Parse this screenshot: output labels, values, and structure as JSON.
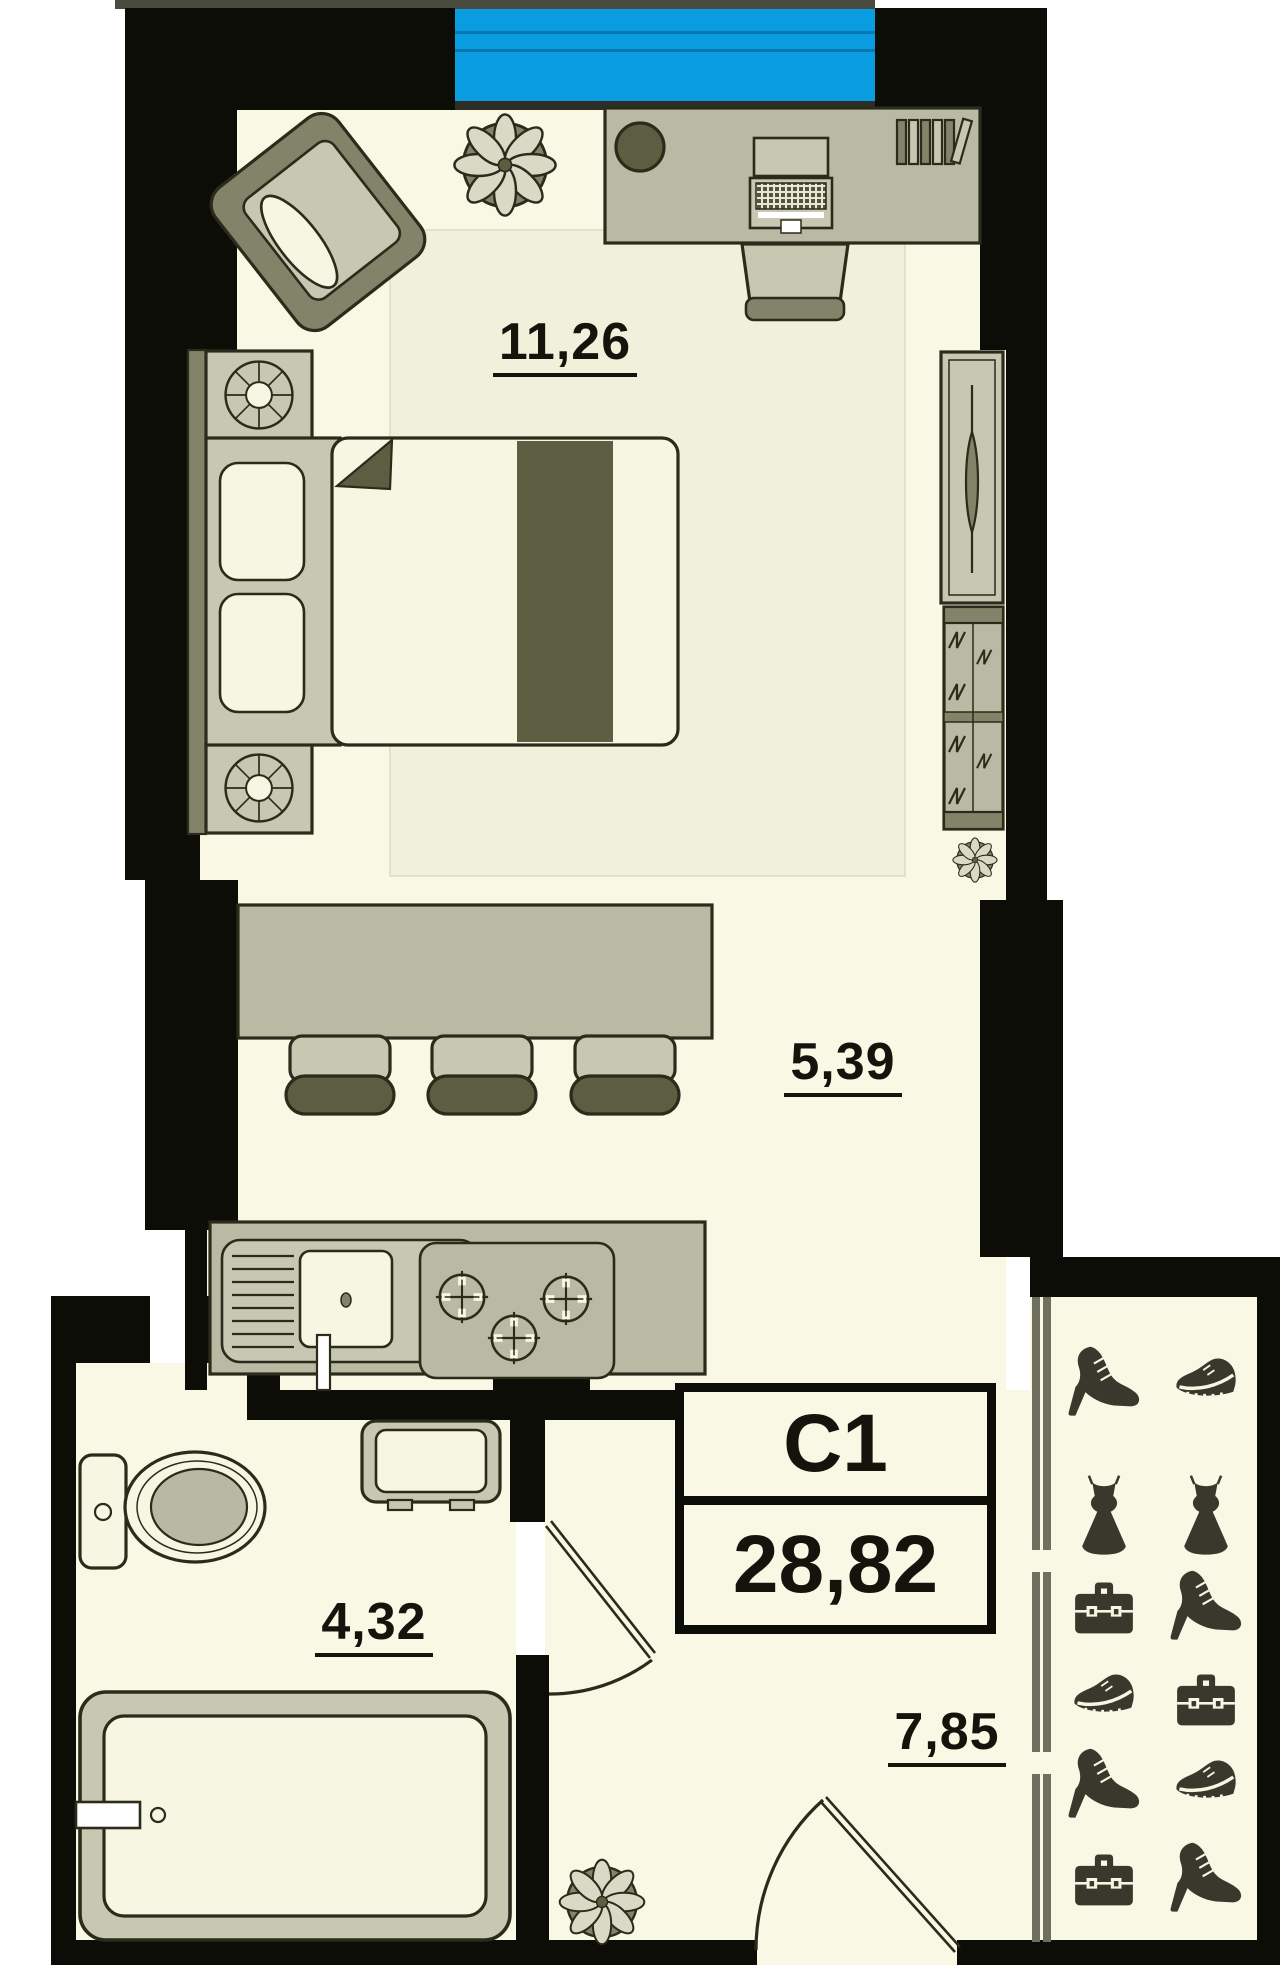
{
  "unit": {
    "code": "C1",
    "total_area": "28,82"
  },
  "rooms": {
    "living": {
      "name": "living-room",
      "area": "11,26"
    },
    "kitchen": {
      "name": "kitchen-zone",
      "area": "5,39"
    },
    "bathroom": {
      "name": "bathroom",
      "area": "4,32"
    },
    "hallway": {
      "name": "hallway",
      "area": "7,85"
    }
  },
  "closet": {
    "type": "sliding-door-wardrobe",
    "icon_rows": [
      [
        "high-heel-shoe",
        "sneaker"
      ],
      [
        "dress",
        "dress"
      ],
      [
        "briefcase",
        "high-heel-shoe"
      ],
      [
        "sneaker",
        "briefcase"
      ],
      [
        "high-heel-shoe",
        "sneaker"
      ],
      [
        "briefcase",
        "high-heel-shoe"
      ]
    ]
  },
  "furniture_visible": [
    "armchair",
    "potted-plant",
    "desk",
    "laptop",
    "books",
    "desk-chair",
    "double-bed",
    "nightstand",
    "table-lamp",
    "wardrobe-with-mirror",
    "chest-of-drawers",
    "bar-table",
    "bar-stool",
    "kitchen-sink",
    "gas-hob",
    "wash-basin",
    "toilet",
    "bathtub",
    "bathroom-door",
    "entrance-door",
    "balcony-window"
  ],
  "colors": {
    "wall": "#0d0d07",
    "line": "#2b2b1b",
    "floor": "#f9f8e5",
    "shade": "#f1f0da",
    "flight": "#c7c7b2",
    "fmid": "#b9b9a4",
    "fdark": "#5d5d41",
    "olive": "#83836a",
    "cream": "#f7f6e3",
    "balcony": "#0a9ce1",
    "balcony_line": "#0878b0",
    "sill": "#2e2e26",
    "railing": "#4a4a40",
    "icon": "#3a382c",
    "outside": "#ffffff",
    "track": "#6f6f60",
    "bowl": "#b8b8a3"
  }
}
